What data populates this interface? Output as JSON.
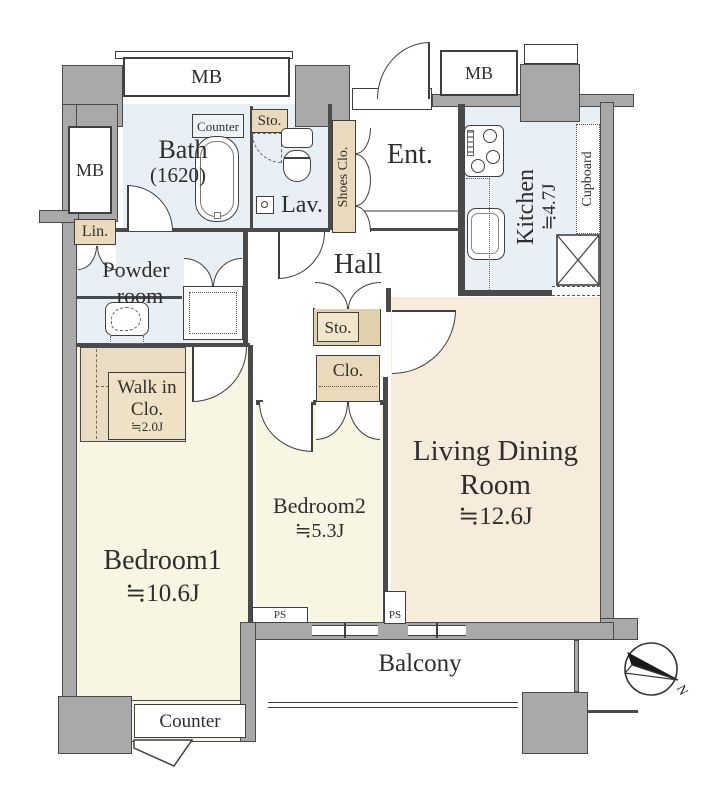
{
  "title": "Apartment floor plan",
  "colors": {
    "wall": "#a9a9a9",
    "outline": "#4a4a4a",
    "line": "#3f3f3f",
    "wet": "#e8f0f5",
    "wet-light": "#edf4f8",
    "cream": "#f8f6e3",
    "peach": "#f7ebdc",
    "tan": "#e9dabb",
    "tan-dark": "#e0d0ab",
    "tan-light": "#f1e6cc",
    "walkin": "#e9dcc2",
    "text": "#2e2e2e"
  },
  "rooms": {
    "bath": {
      "name": "Bath",
      "size": "(1620)"
    },
    "lavatory": {
      "name": "Lav."
    },
    "entrance": {
      "name": "Ent."
    },
    "hall": {
      "name": "Hall"
    },
    "powder": {
      "line1": "Powder",
      "line2": "room"
    },
    "kitchen": {
      "name": "Kitchen",
      "size": "≒4.7J"
    },
    "bedroom1": {
      "name": "Bedroom1",
      "size": "≒10.6J"
    },
    "bedroom2": {
      "name": "Bedroom2",
      "size": "≒5.3J"
    },
    "living_dining": {
      "line1": "Living Dining",
      "line2": "Room",
      "size": "≒12.6J"
    },
    "walk_in_closet": {
      "line1": "Walk in",
      "line2": "Clo.",
      "size": "≒2.0J"
    },
    "balcony": {
      "name": "Balcony"
    }
  },
  "fixtures": {
    "mb_top_left": "MB",
    "mb_top_right": "MB",
    "mb_side": "MB",
    "bath_counter": "Counter",
    "sto_bath": "Sto.",
    "sto_hall": "Sto.",
    "lin": "Lin.",
    "clo": "Clo.",
    "shoes_closet": "Shoes Clo.",
    "cupboard": "Cupboard",
    "ps_1": "PS",
    "ps_2": "PS",
    "bedroom1_counter": "Counter"
  },
  "compass": {
    "north_label": "N"
  }
}
